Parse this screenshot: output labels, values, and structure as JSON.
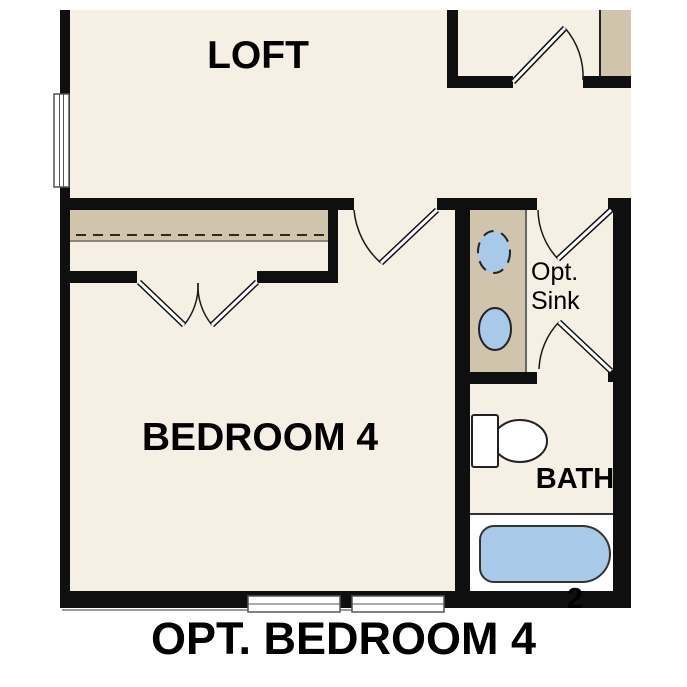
{
  "plan_title": "OPT. BEDROOM 4",
  "rooms": {
    "loft": {
      "label": "LOFT"
    },
    "bedroom4": {
      "label": "BEDROOM 4"
    },
    "bath2": {
      "label_line1": "BATH",
      "label_line2": "2"
    },
    "vanity_note": {
      "line1": "Opt.",
      "line2": "Sink"
    }
  },
  "caption": "OPT. BEDROOM 4",
  "fixtures": [
    "toilet",
    "bathtub",
    "sink-optional-dashed",
    "sink",
    "closet-rod-dashed",
    "window",
    "door-swing",
    "double-closet-doors"
  ],
  "colors": {
    "wall": "#0f0f0f",
    "floor": "#f6efe4",
    "cabinet": "#d0c4ac",
    "fixture": "#a9c9e9",
    "outline": "#333333",
    "background": "#ffffff",
    "text": "#000000"
  }
}
